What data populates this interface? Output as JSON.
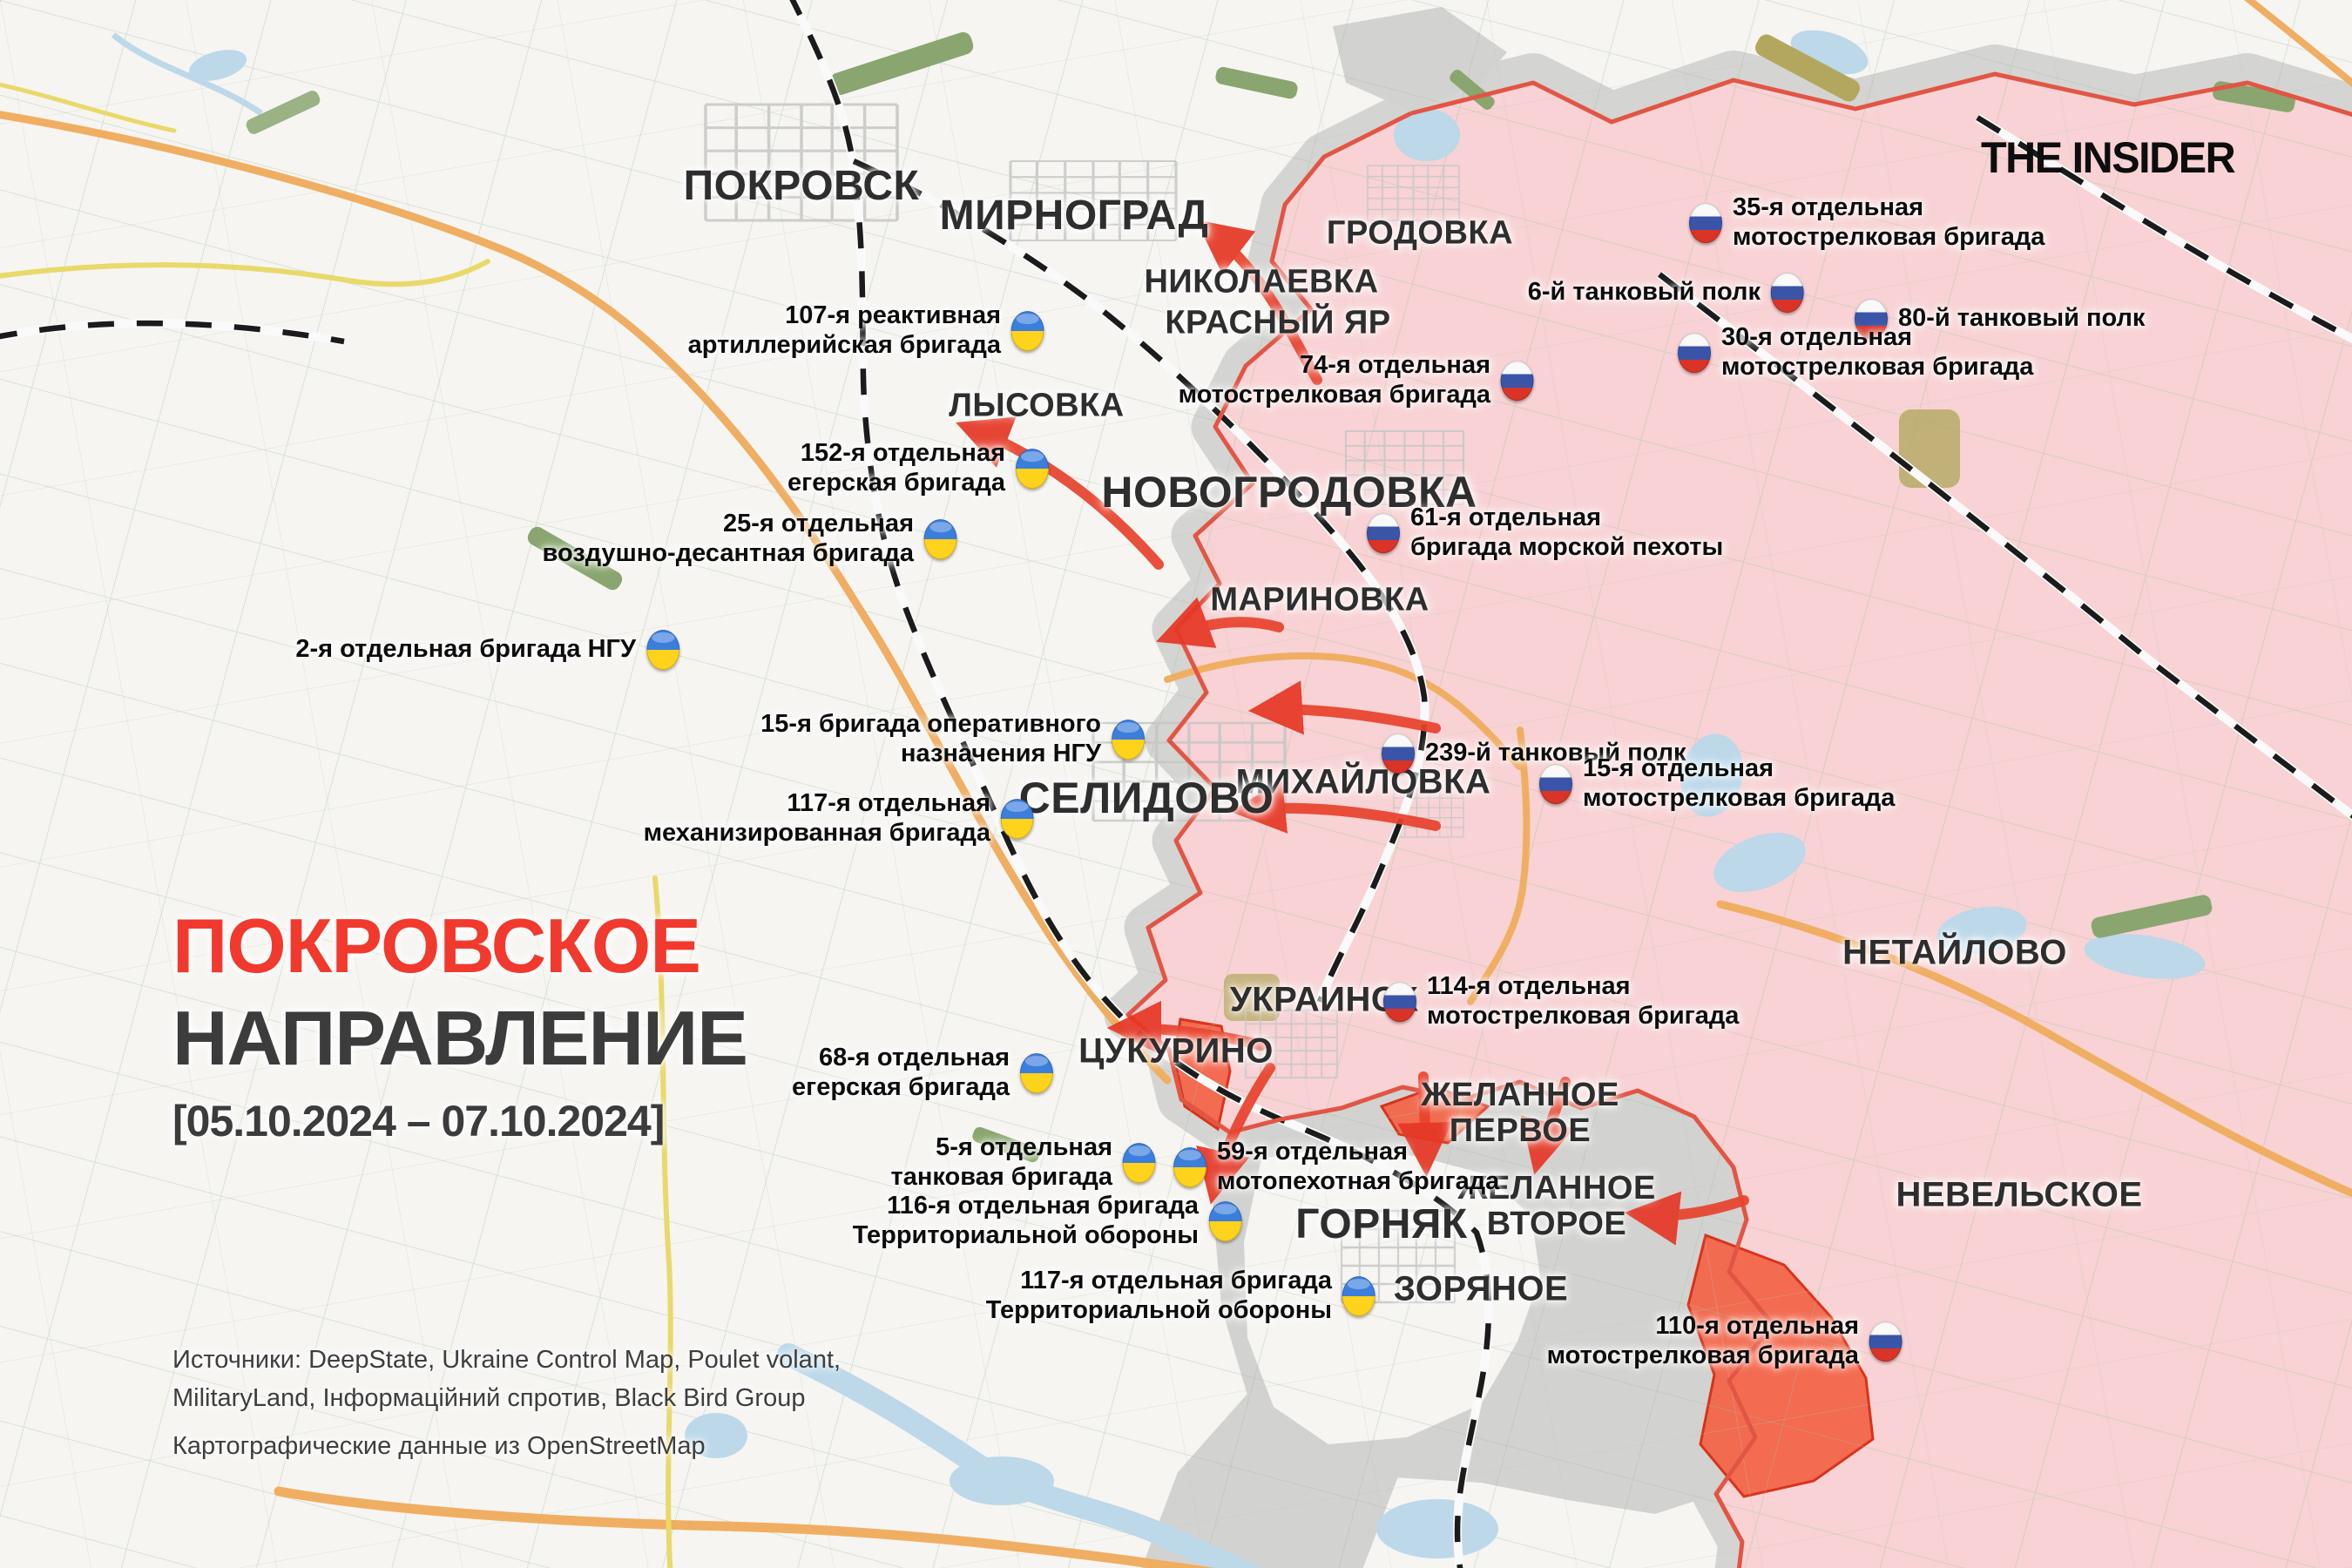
{
  "branding": {
    "logo": "THE INSIDER"
  },
  "title": {
    "line1": "ПОКРОВСКОЕ",
    "line2": "НАПРАВЛЕНИЕ",
    "dates": "[05.10.2024 – 07.10.2024]"
  },
  "sources": {
    "line1": "Источники: DeepState, Ukraine Control Map, Poulet volant,",
    "line2": "MilitaryLand, Інформаційний спротив, Black Bird Group",
    "line3": "Картографические данные из OpenStreetMap"
  },
  "cities": [
    {
      "name": "ПОКРОВСК"
    },
    {
      "name": "МИРНОГРАД"
    },
    {
      "name": "НИКОЛАЕВКА"
    },
    {
      "name": "КРАСНЫЙ ЯР"
    },
    {
      "name": "ГРОДОВКА"
    },
    {
      "name": "ЛЫСОВКА"
    },
    {
      "name": "НОВОГРОДОВКА"
    },
    {
      "name": "МАРИНОВКА"
    },
    {
      "name": "МИХАЙЛОВКА"
    },
    {
      "name": "СЕЛИДОВО"
    },
    {
      "name": "НЕТАЙЛОВО"
    },
    {
      "name": "УКРАИНСК"
    },
    {
      "name": "ЦУКУРИНО"
    },
    {
      "name": "ЖЕЛАННОЕ\nПЕРВОЕ"
    },
    {
      "name": "ЖЕЛАННОЕ\nВТОРОЕ"
    },
    {
      "name": "ГОРНЯК"
    },
    {
      "name": "ЗОРЯНОЕ"
    },
    {
      "name": "НЕВЕЛЬСКОЕ"
    }
  ],
  "ua_units": [
    {
      "text": "107-я реактивная\nартиллерийская бригада"
    },
    {
      "text": "152-я отдельная\nегерская бригада"
    },
    {
      "text": "25-я отдельная\nвоздушно-десантная бригада"
    },
    {
      "text": "2-я отдельная бригада НГУ"
    },
    {
      "text": "15-я бригада оперативного\nназначения НГУ"
    },
    {
      "text": "117-я отдельная\nмеханизированная бригада"
    },
    {
      "text": "68-я отдельная\nегерская бригада"
    },
    {
      "text": "5-я отдельная\nтанковая бригада"
    },
    {
      "text": "59-я отдельная\nмотопехотная бригада"
    },
    {
      "text": "116-я отдельная бригада\nТерриториальной обороны"
    },
    {
      "text": "117-я отдельная бригада\nТерриториальной обороны"
    }
  ],
  "ru_units": [
    {
      "text": "35-я отдельная\nмотострелковая бригада"
    },
    {
      "text": "6-й танковый полк"
    },
    {
      "text": "80-й танковый полк"
    },
    {
      "text": "30-я отдельная\nмотострелковая бригада"
    },
    {
      "text": "74-я отдельная\nмотострелковая бригада"
    },
    {
      "text": "61-я отдельная\nбригада морской пехоты"
    },
    {
      "text": "239-й танковый полк"
    },
    {
      "text": "15-я отдельная\nмотострелковая бригада"
    },
    {
      "text": "114-я отдельная\nмотострелковая бригада"
    },
    {
      "text": "110-я отдельная\nмотострелковая бригада"
    }
  ],
  "colors": {
    "russian_controlled_fill": "#f8d2d4",
    "frontline_red": "#e25544",
    "contested_gray": "#d2d2d0",
    "recent_advance_fill": "#f3664a",
    "recent_advance_border": "#d92b12",
    "attack_arrow": "#e8432e",
    "title_red": "#f2392d",
    "road_orange": "#efae62",
    "road_yellow": "#e9d96a",
    "water_blue": "#bcd8e9",
    "ua_flag_blue": "#3c7edc",
    "ua_flag_yellow": "#ffd21c",
    "ru_flag_blue": "#3a55a8",
    "ru_flag_red": "#d93427"
  }
}
